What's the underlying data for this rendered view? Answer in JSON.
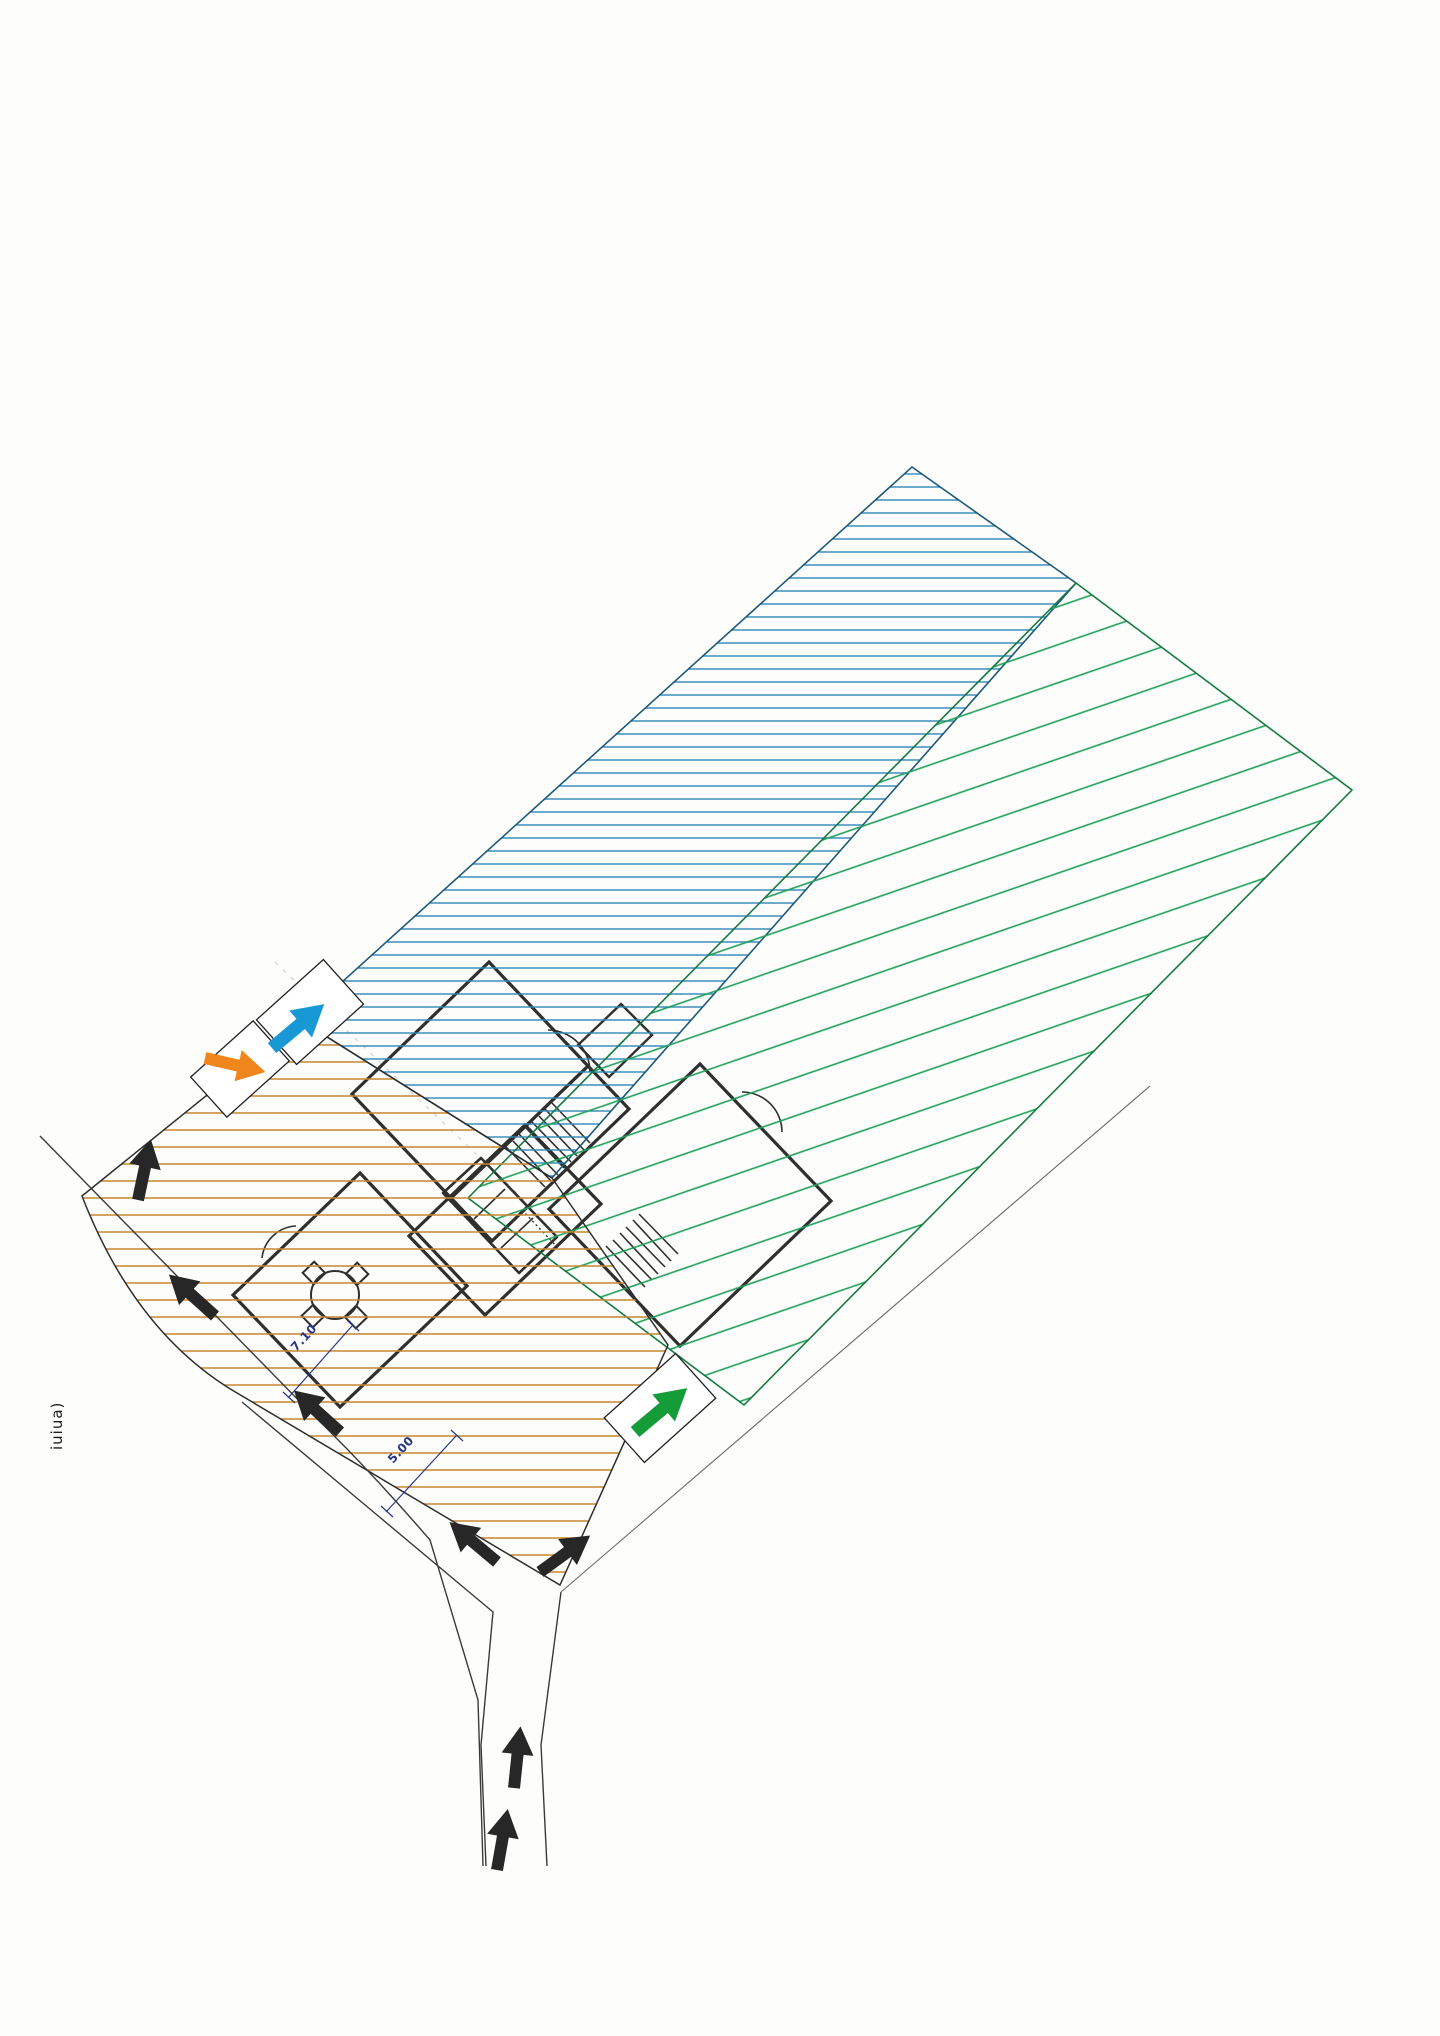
{
  "document": {
    "kind": "scanned architectural site plan",
    "background_color": "#fdfdfc"
  },
  "labels": {
    "dimension_upper": "7.10",
    "dimension_lower": "5.00",
    "street_label_vertical": "iuiua)"
  },
  "regions": [
    {
      "name": "north-view-corridor",
      "hatch": "horizontal",
      "color": "#2f86b8",
      "outline": "#1d5a7a"
    },
    {
      "name": "east-view-corridor",
      "hatch": "diagonal",
      "color": "#1fa05a",
      "outline": "#157a42"
    },
    {
      "name": "garden-plot-area",
      "hatch": "horizontal",
      "color": "#c5862f",
      "outline": "#2e2e2e"
    }
  ],
  "arrows": {
    "blue_arrow_color": "#1899d6",
    "orange_arrow_color": "#f0871c",
    "green_arrow_color": "#149c38",
    "road_arrow_color": "#272727",
    "road_arrow_count": 7
  },
  "dimension_color": "#26358c",
  "building": {
    "rooms": [
      "upper-room",
      "stair-hall",
      "garage-with-car",
      "living-room-with-table",
      "second-unit-room"
    ]
  }
}
